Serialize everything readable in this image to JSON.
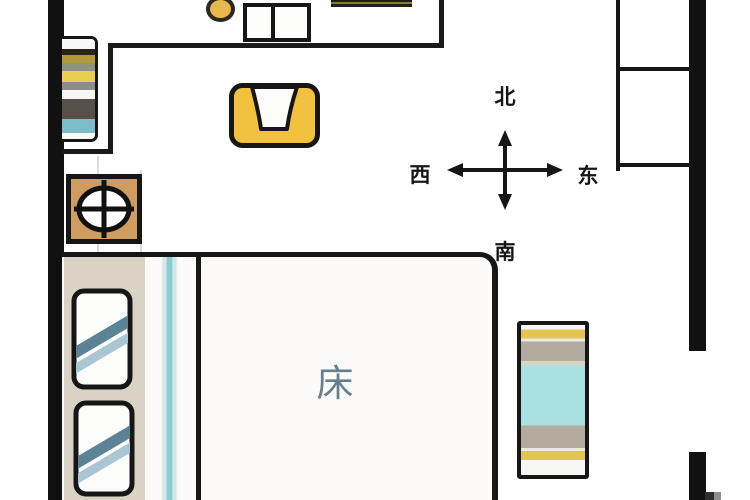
{
  "compass": {
    "north": "北",
    "south": "南",
    "west": "西",
    "east": "东"
  },
  "room": {
    "bed_label": "床"
  },
  "colors": {
    "wall": "#111111",
    "line": "#1a1a1a",
    "armchair_yellow": "#F2C23E",
    "stove_tan": "#CE9D5F",
    "headboard_beige": "#D9D3C6",
    "pillow_stripe_dark": "#5C8296",
    "pillow_stripe_light": "#A9C6D2",
    "runner_teal": "#8CCBD0",
    "runner_teal_light": "#CFE9E9",
    "bench_cyan": "#A9E1E3",
    "bench_gray": "#B3AB9D",
    "bench_yellow": "#E3C64F",
    "bed_label_color": "#64808E",
    "shelf_yellow": "#E8CF52",
    "shelf_olive": "#B09A3C",
    "shelf_gray": "#8E8E86",
    "shelf_dark": "#55504A",
    "shelf_blue": "#7CBCC8",
    "dot_yellow": "#E8B84A"
  }
}
